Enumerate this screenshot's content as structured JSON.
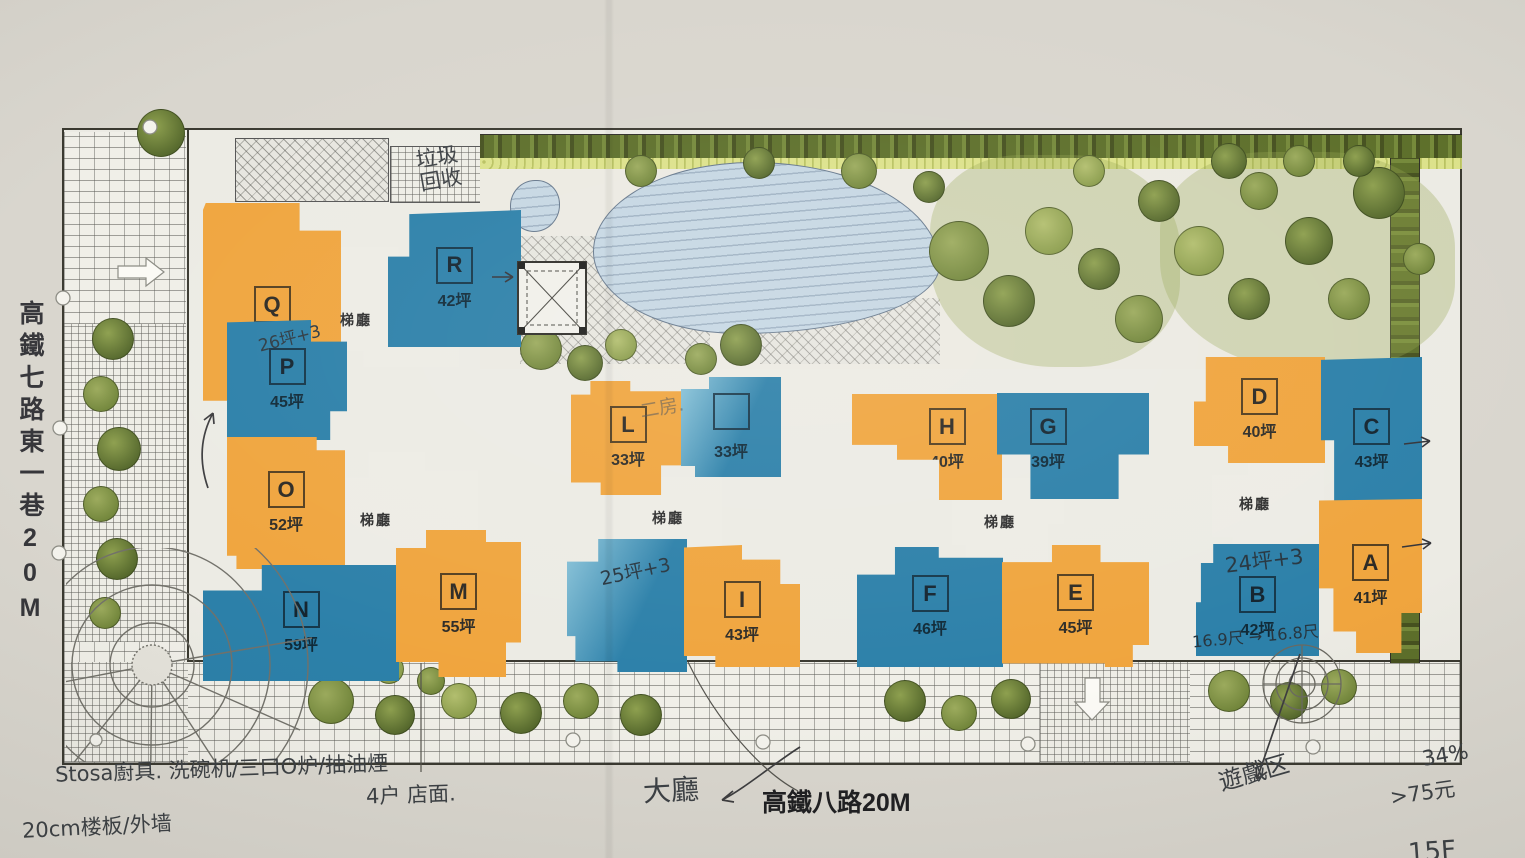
{
  "site": {
    "left_road_label": "高鐵七路東一巷20M",
    "bottom_road_label": "高鐵八路20M",
    "stair_hall": "梯廳"
  },
  "units": {
    "Q": {
      "letter": "Q",
      "area": "43坪",
      "color": "orange"
    },
    "R": {
      "letter": "R",
      "area": "42坪",
      "color": "blue"
    },
    "P": {
      "letter": "P",
      "area": "45坪",
      "color": "blue"
    },
    "O": {
      "letter": "O",
      "area": "52坪",
      "color": "orange"
    },
    "N": {
      "letter": "N",
      "area": "59坪",
      "color": "blue"
    },
    "M": {
      "letter": "M",
      "area": "55坪",
      "color": "orange"
    },
    "L": {
      "letter": "L",
      "area": "33坪",
      "color": "orange"
    },
    "K": {
      "letter": "",
      "area": "33坪",
      "color": "blue"
    },
    "I": {
      "letter": "I",
      "area": "43坪",
      "color": "orange"
    },
    "H": {
      "letter": "H",
      "area": "40坪",
      "color": "orange"
    },
    "G": {
      "letter": "G",
      "area": "39坪",
      "color": "blue"
    },
    "F": {
      "letter": "F",
      "area": "46坪",
      "color": "blue"
    },
    "E": {
      "letter": "E",
      "area": "45坪",
      "color": "orange"
    },
    "D": {
      "letter": "D",
      "area": "40坪",
      "color": "orange"
    },
    "C": {
      "letter": "C",
      "area": "43坪",
      "color": "blue"
    },
    "B": {
      "letter": "B",
      "area": "42坪",
      "color": "blue"
    },
    "A": {
      "letter": "A",
      "area": "41坪",
      "color": "orange"
    }
  },
  "handwritten": {
    "recycle_note": "垃圾\n回收",
    "p_note": "26坪+3",
    "two_room_note": "二房.",
    "j_note": "25坪+3",
    "b_note_top": "24坪+3",
    "b_note_bottom": "16.9尺 → 16.8尺",
    "kitchen_note": "Stosa廚具. 洗碗机/三口O炉/抽油煙",
    "slab_note": "20cm楼板/外墙",
    "storefront_note": "4户 店面.",
    "lobby_note": "大廳",
    "play_area_note": "遊戲区",
    "percent_note": "34%",
    "price_note": ">75元",
    "floor_note": "15F"
  },
  "colors": {
    "unit_orange": "#F0A53E",
    "unit_blue": "#2C80A9",
    "pond": "#C6D7E3",
    "hedge": "#5D6F2A",
    "tree": "#79893D",
    "paper": "#ECEBE4"
  }
}
